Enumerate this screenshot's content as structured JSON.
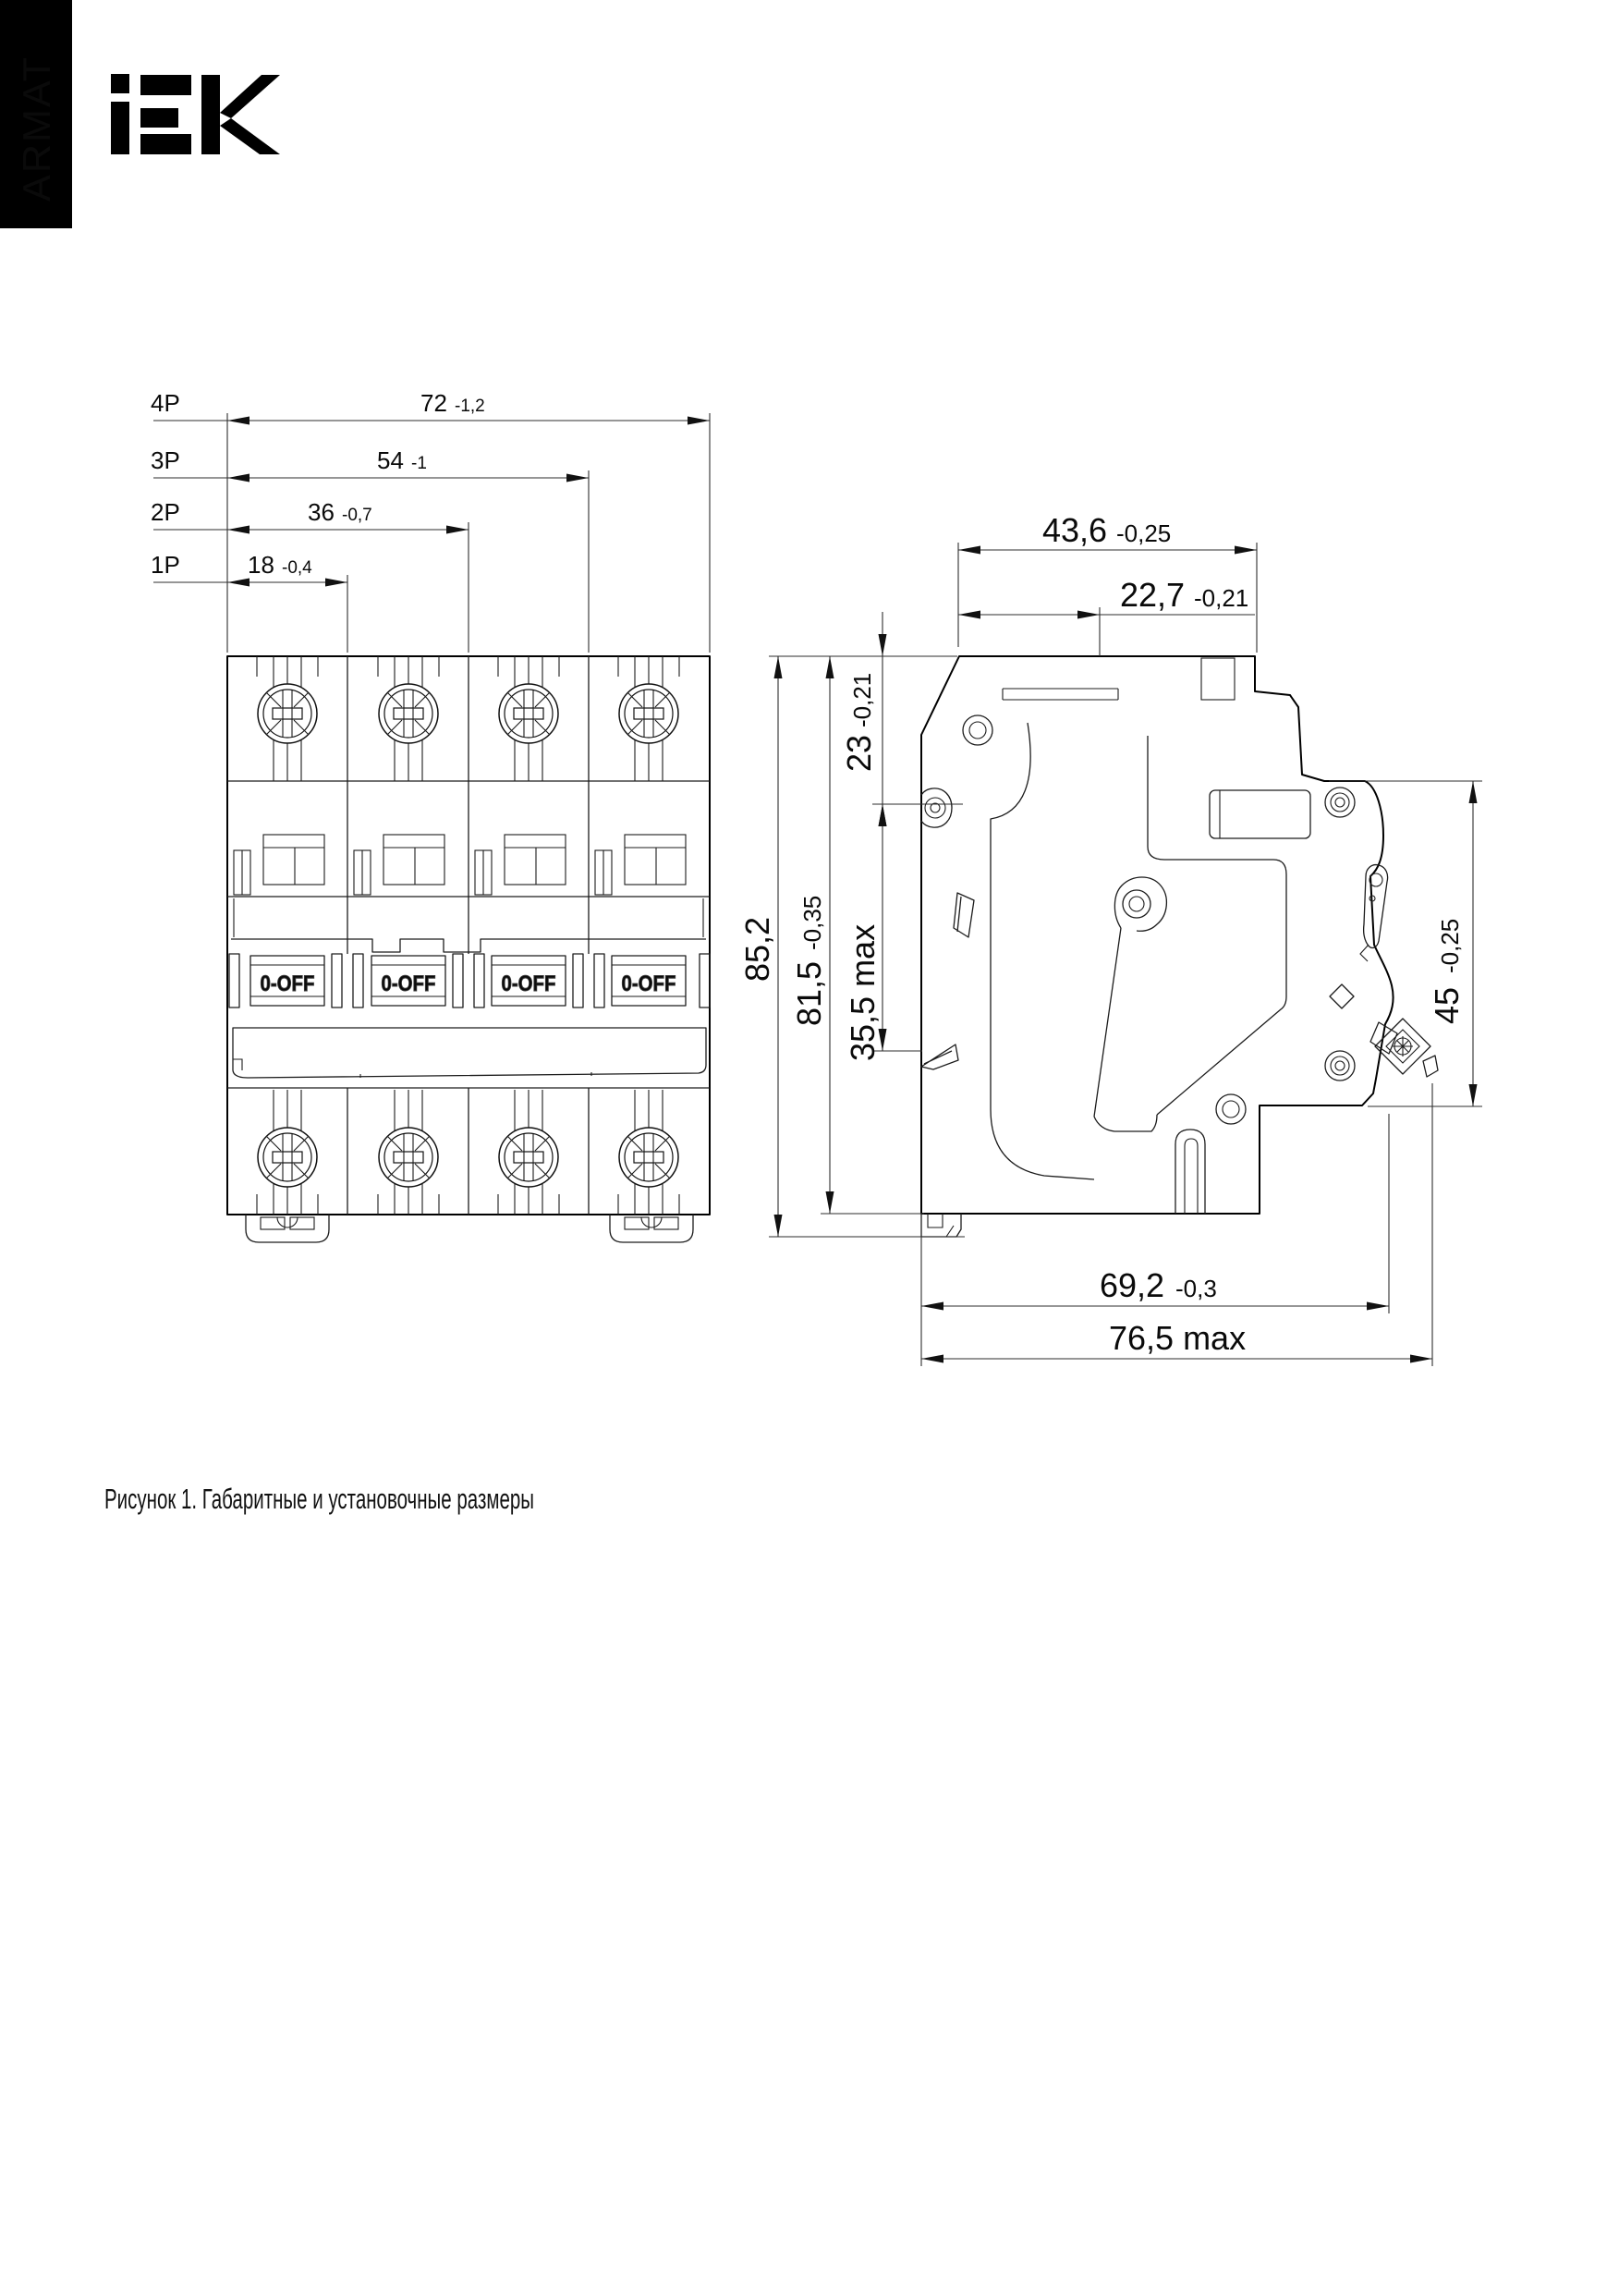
{
  "header": {
    "brand_vertical": "ARMAT",
    "logo_text": "IEK"
  },
  "caption": "Рисунок 1. Габаритные и установочные размеры",
  "front_view": {
    "pole_rows": [
      {
        "pole": "4P",
        "value": "72",
        "tol": "-1,2"
      },
      {
        "pole": "3P",
        "value": "54",
        "tol": "-1"
      },
      {
        "pole": "2P",
        "value": "36",
        "tol": "-0,7"
      },
      {
        "pole": "1P",
        "value": "18",
        "tol": "-0,4"
      }
    ],
    "toggle_label": "0-OFF"
  },
  "side_view": {
    "dims": {
      "top_width": {
        "value": "43,6",
        "tol": "-0,25"
      },
      "handle_offset": {
        "value": "22,7",
        "tol": "-0,21"
      },
      "total_height": {
        "value": "85,2",
        "tol": ""
      },
      "case_height": {
        "value": "81,5",
        "tol": "-0,35"
      },
      "rail_offset": {
        "value": "23",
        "tol": "-0,21"
      },
      "rail_depth": {
        "value": "35,5 max",
        "tol": ""
      },
      "front_height": {
        "value": "45",
        "tol": "-0,25"
      },
      "depth": {
        "value": "69,2",
        "tol": "-0,3"
      },
      "depth_max": {
        "value": "76,5 max",
        "tol": ""
      }
    }
  }
}
